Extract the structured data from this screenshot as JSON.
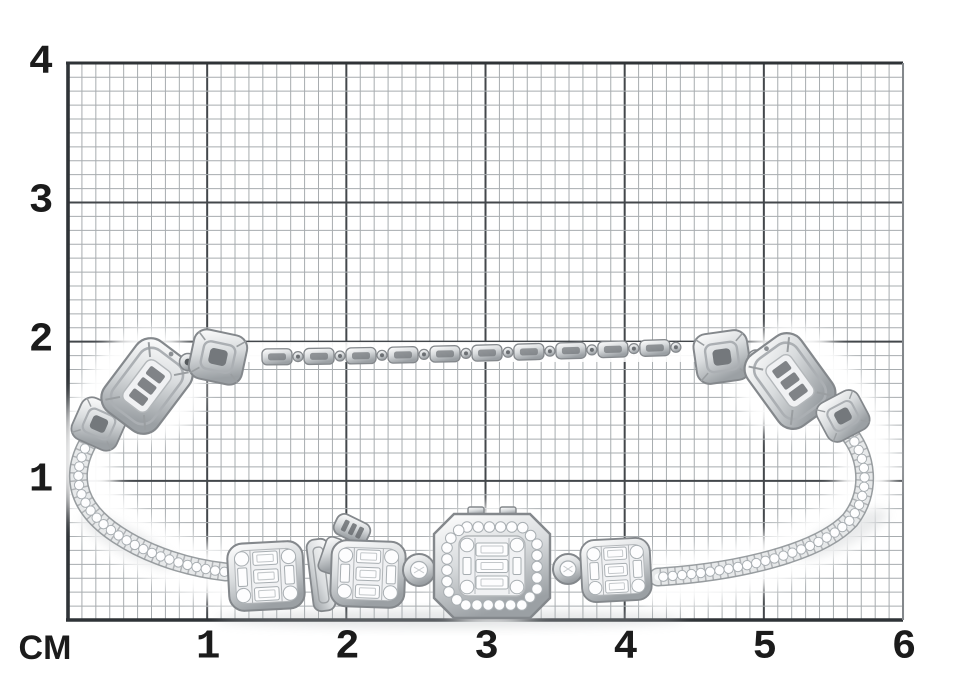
{
  "meta": {
    "view": "product photo of jewelry on measuring grid paper",
    "background": "#ffffff"
  },
  "ruler": {
    "unit_label": "CM",
    "x_labels": [
      "1",
      "2",
      "3",
      "4",
      "5",
      "6"
    ],
    "y_labels": [
      "4",
      "3",
      "2",
      "1"
    ],
    "x_cm": 6,
    "y_cm": 4,
    "minor_per_cm": 10
  },
  "photo": {
    "subject": "white gold diamond bracelet lying on centimeter grid",
    "style": "tennis bracelet with round diamond lines, baguette cluster stations and octagonal halo center station",
    "elements": [
      "top bar-link chain",
      "large openwork cushion cluster link left",
      "large openwork cushion cluster link right",
      "four small square links",
      "left round-diamond line",
      "right round-diamond line",
      "three baguette cluster stations",
      "octagonal halo center station",
      "two round bezel-set diamonds",
      "box clasp fold with safety tongue"
    ],
    "approx_width_cm": 5.9,
    "approx_height_cm": 2.1
  },
  "colors": {
    "background": "#ffffff",
    "grid_minor": "#a7acaf",
    "grid_major": "#43474b",
    "grid_frame_dark": "#2f3337",
    "grid_frame_right": "#83878b",
    "axis_text": "#1b1b1b",
    "metal_light": "#ffffff",
    "metal_mid": "#d9dcde",
    "metal_deep": "#9ba0a4",
    "metal_outline": "#84888c",
    "stone_fill": "#fdfdfe",
    "stone_stroke": "#a8aeb2",
    "tick": "#8e9296",
    "shadow": "#b4b8bb"
  },
  "grid_geometry": {
    "left": 68,
    "top": 63,
    "right": 903,
    "bottom": 620,
    "cm_px": 139.17
  }
}
